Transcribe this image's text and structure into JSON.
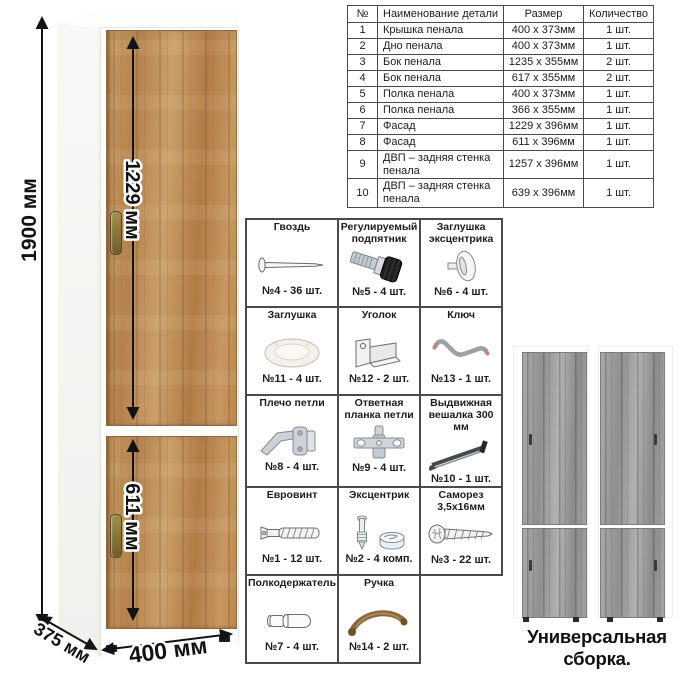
{
  "dimensions": {
    "height": "1900 мм",
    "upper_door": "1229 мм",
    "lower_door": "611 мм",
    "depth": "375 мм",
    "width": "400 мм"
  },
  "parts_table": {
    "headers": [
      "№",
      "Наименование детали",
      "Размер",
      "Количество"
    ],
    "rows": [
      {
        "num": "1",
        "name": "Крышка пенала",
        "size": "400 х 373мм",
        "qty": "1 шт."
      },
      {
        "num": "2",
        "name": "Дно пенала",
        "size": "400 х 373мм",
        "qty": "1 шт."
      },
      {
        "num": "3",
        "name": "Бок пенала",
        "size": "1235 х 355мм",
        "qty": "2 шт."
      },
      {
        "num": "4",
        "name": "Бок пенала",
        "size": "617 х 355мм",
        "qty": "2 шт."
      },
      {
        "num": "5",
        "name": "Полка пенала",
        "size": "400 х 373мм",
        "qty": "1 шт."
      },
      {
        "num": "6",
        "name": "Полка пенала",
        "size": "366 х 355мм",
        "qty": "1 шт."
      },
      {
        "num": "7",
        "name": "Фасад",
        "size": "1229 х 396мм",
        "qty": "1 шт."
      },
      {
        "num": "8",
        "name": "Фасад",
        "size": "611 х 396мм",
        "qty": "1 шт."
      },
      {
        "num": "9",
        "name": "ДВП – задняя стенка пенала",
        "size": "1257 х 396мм",
        "qty": "1 шт."
      },
      {
        "num": "10",
        "name": "ДВП – задняя стенка пенала",
        "size": "639 х 396мм",
        "qty": "1 шт."
      }
    ]
  },
  "hardware": {
    "items": [
      {
        "title": "Гвоздь",
        "icon": "nail-icon",
        "qty": "№4 - 36 шт."
      },
      {
        "title": "Регулируемый подпятник",
        "icon": "adjustable-foot-icon",
        "qty": "№5 - 4 шт."
      },
      {
        "title": "Заглушка эксцентрика",
        "icon": "cam-cover-icon",
        "qty": "№6 - 4 шт."
      },
      {
        "title": "Заглушка",
        "icon": "cap-icon",
        "qty": "№11 - 4 шт."
      },
      {
        "title": "Уголок",
        "icon": "corner-bracket-icon",
        "qty": "№12 - 2 шт."
      },
      {
        "title": "Ключ",
        "icon": "hex-key-icon",
        "qty": "№13 - 1 шт."
      },
      {
        "title": "Плечо петли",
        "icon": "hinge-arm-icon",
        "qty": "№8 - 4 шт."
      },
      {
        "title": "Ответная планка петли",
        "icon": "hinge-plate-icon",
        "qty": "№9 - 4 шт."
      },
      {
        "title": "Выдвижная вешалка 300 мм",
        "icon": "pullout-hanger-icon",
        "qty": "№10 - 1 шт."
      },
      {
        "title": "Евровинт",
        "icon": "euro-screw-icon",
        "qty": "№1 - 12 шт."
      },
      {
        "title": "Эксцентрик",
        "icon": "cam-lock-icon",
        "qty": "№2 - 4 комп."
      },
      {
        "title": "Саморез 3,5х16мм",
        "icon": "self-tapping-screw-icon",
        "qty": "№3 - 22 шт."
      },
      {
        "title": "Полкодержатель",
        "icon": "shelf-pin-icon",
        "qty": "№7 - 4 шт."
      },
      {
        "title": "Ручка",
        "icon": "handle-icon",
        "qty": "№14 - 2 шт."
      }
    ]
  },
  "footer": {
    "caption": "Универсальная сборка."
  },
  "colors": {
    "wood": "#c1905a",
    "wood_dark": "#97683c",
    "gray_wood": "#9e9e9e",
    "gray_wood_dark": "#7d7d7d",
    "handle_bronze": "#8a7a3a",
    "arrow": "#121212",
    "table_border": "#4a4a4a"
  }
}
